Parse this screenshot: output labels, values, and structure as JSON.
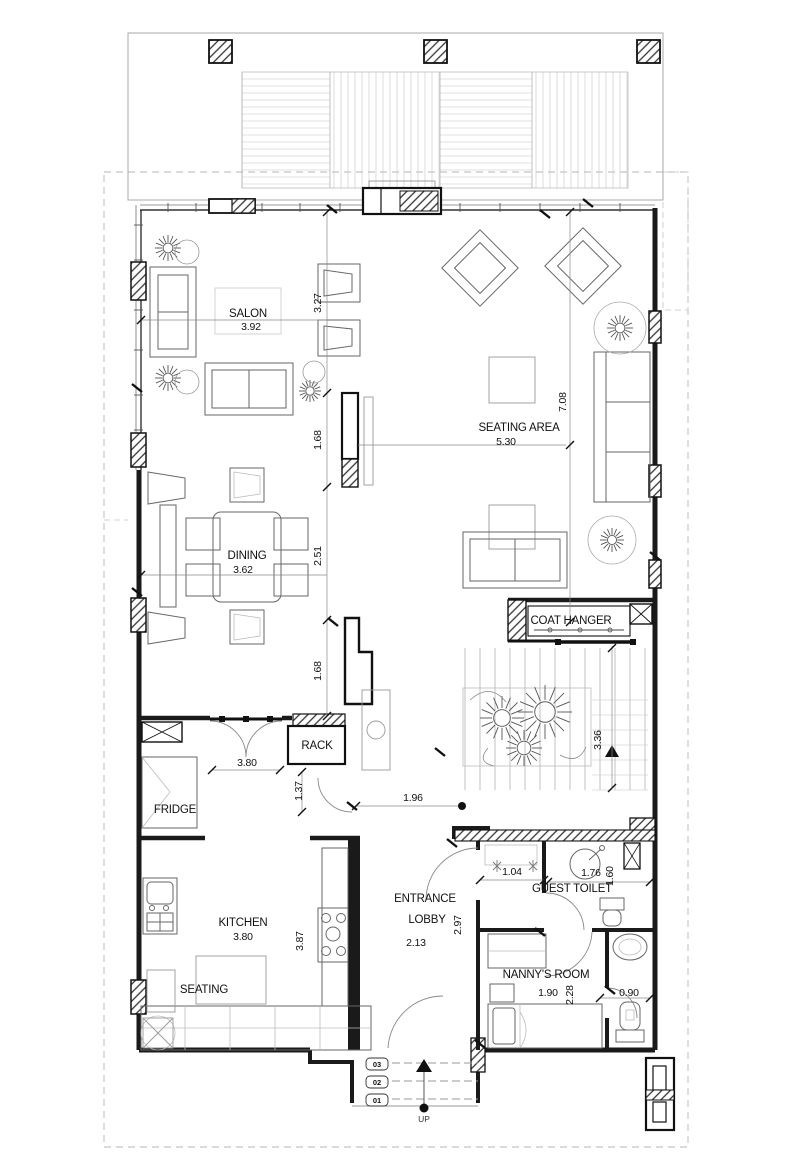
{
  "drawing": {
    "type_label": "ground-floor-plan"
  },
  "rooms": {
    "salon": {
      "name": "SALON",
      "width": "3.92"
    },
    "seating_area": {
      "name": "SEATING AREA",
      "width": "5.30"
    },
    "dining": {
      "name": "DINING",
      "width": "3.62"
    },
    "coat_hanger": {
      "name": "COAT HANGER"
    },
    "rack": {
      "name": "RACK"
    },
    "fridge": {
      "name": "FRIDGE"
    },
    "kitchen": {
      "name": "KITCHEN",
      "width": "3.80"
    },
    "kitchen_seating": {
      "name": "SEATING"
    },
    "entrance_lobby": {
      "line1": "ENTRANCE",
      "line2": "LOBBY",
      "width": "2.13"
    },
    "guest_toilet": {
      "name": "GUEST TOILET"
    },
    "nannys_room": {
      "name": "NANNY'S ROOM",
      "width": "1.90"
    }
  },
  "dimensions": {
    "salon_depth": "3.27",
    "tv_wall_upper": "1.68",
    "dining_depth": "2.51",
    "dining_lower": "1.68",
    "seating_area_depth": "7.08",
    "stair_hall": "3.36",
    "corridor_opening": "3.80",
    "fridge_nook": "1.37",
    "hall_width": "1.96",
    "shower_width": "1.04",
    "toilet_width": "1.76",
    "toilet_depth": "1.60",
    "kitchen_depth": "3.87",
    "lobby_depth": "2.97",
    "nanny_depth": "2.28",
    "wc_width": "0.90"
  },
  "entry_steps": {
    "step_top": "03",
    "step_mid": "02",
    "step_low": "01",
    "direction": "UP"
  }
}
